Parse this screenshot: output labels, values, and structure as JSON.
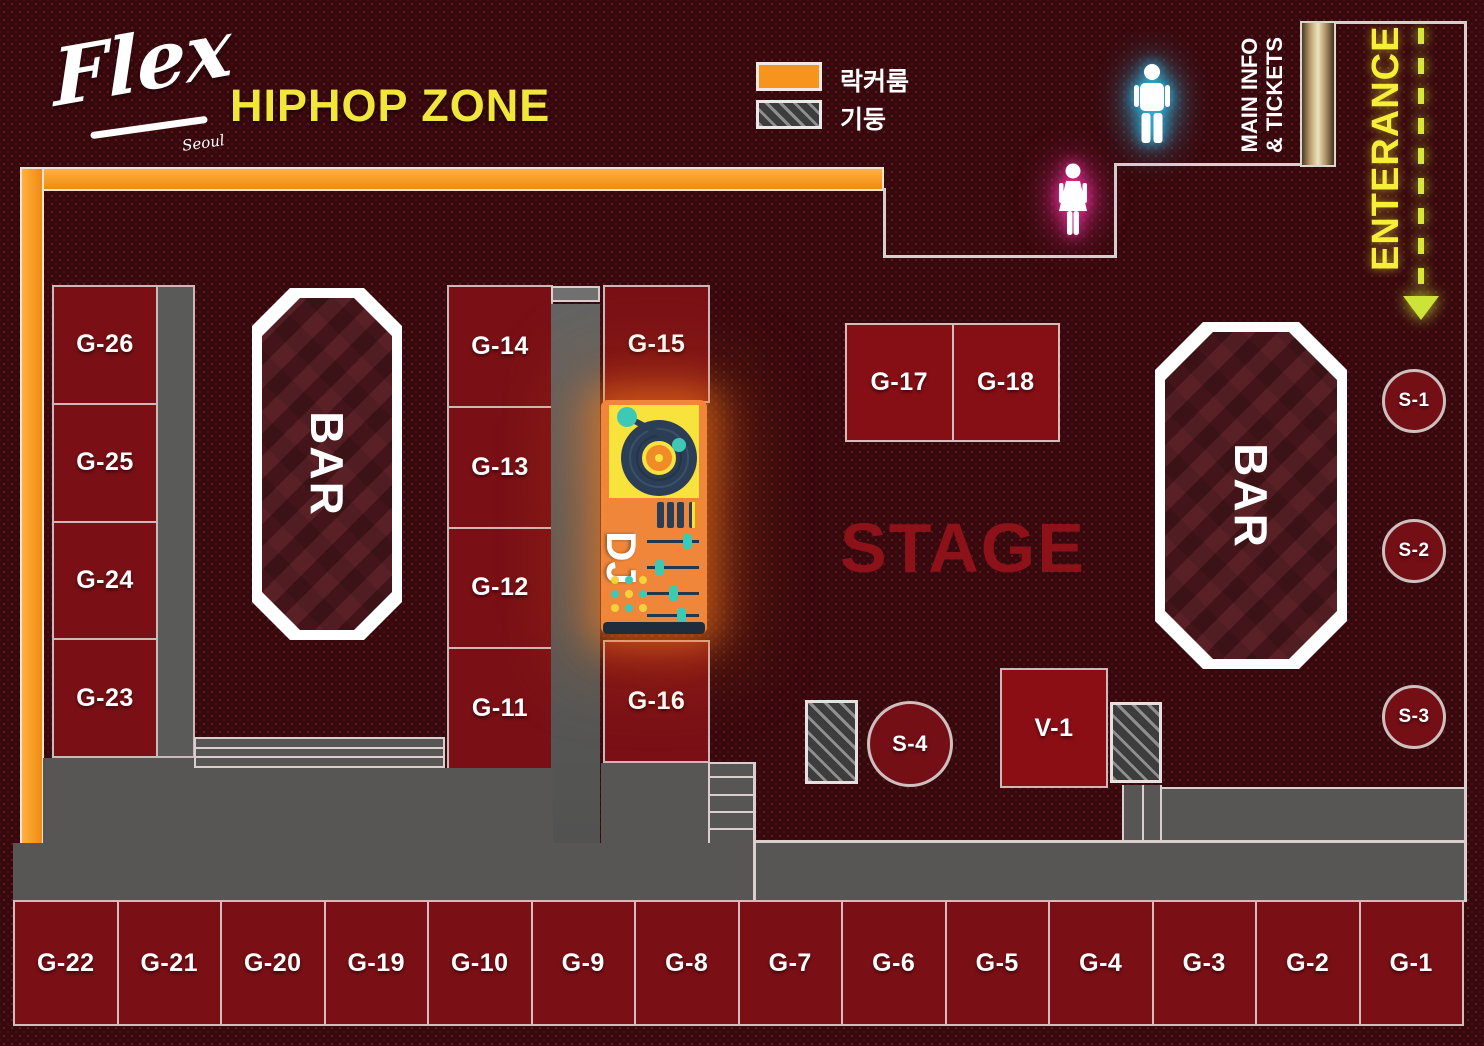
{
  "title": {
    "logo": "Flex",
    "logo_sub": "Seoul",
    "zone": "HIPHOP ZONE"
  },
  "legend": {
    "locker_label": "락커룸",
    "pillar_label": "기둥"
  },
  "signs": {
    "main_info_line1": "MAIN INFO",
    "main_info_line2": "& TICKETS",
    "entrance": "ENTERANCE",
    "stage": "STAGE",
    "bar": "BAR",
    "dj": "DJ"
  },
  "tables": {
    "left_column": [
      "G-26",
      "G-25",
      "G-24",
      "G-23"
    ],
    "mid_column": [
      "G-14",
      "G-13",
      "G-12",
      "G-11"
    ],
    "dj_column": [
      "G-15",
      "G-16"
    ],
    "stage_tables": [
      "G-17",
      "G-18"
    ],
    "vip_table": "V-1",
    "sofa_seats": [
      "S-1",
      "S-2",
      "S-3",
      "S-4"
    ],
    "bottom_row": [
      "G-22",
      "G-21",
      "G-20",
      "G-19",
      "G-10",
      "G-9",
      "G-8",
      "G-7",
      "G-6",
      "G-5",
      "G-4",
      "G-3",
      "G-2",
      "G-1"
    ]
  },
  "colors": {
    "background": "#36090e",
    "table_fill": "#7a1016",
    "accent_orange": "#f6941e",
    "accent_yellow": "#f2e63a",
    "walkway_gray": "#575655",
    "stage_text": "#8c1118",
    "male_glow": "#2ec2f0",
    "female_glow": "#f02f9e",
    "dj_teal": "#3ec9b6",
    "dj_panel_yellow": "#f8e33c"
  }
}
